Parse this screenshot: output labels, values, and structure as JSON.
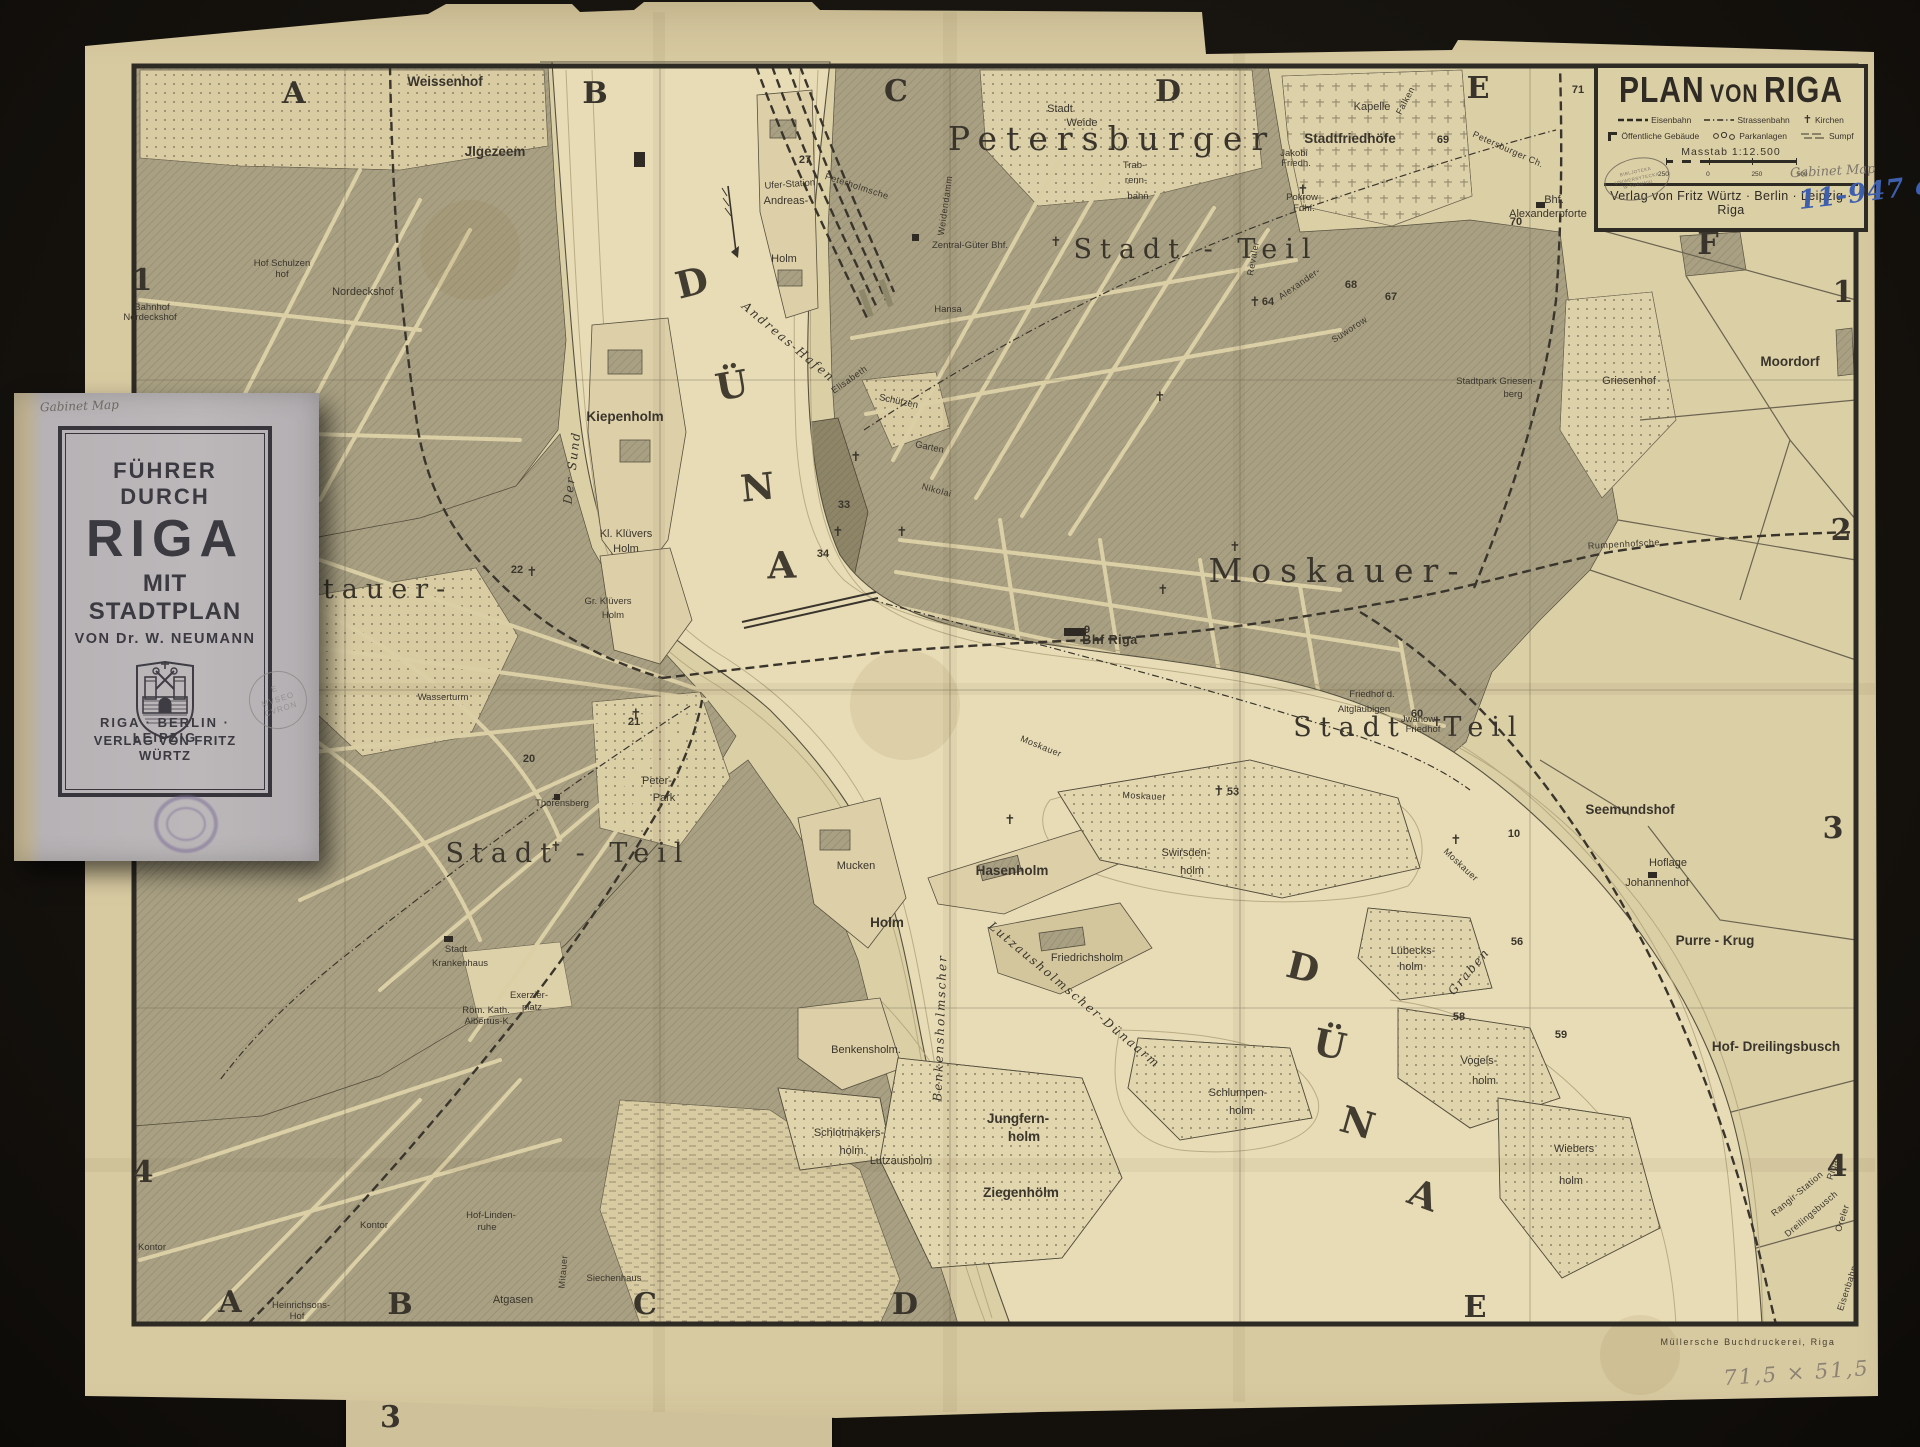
{
  "cartouche": {
    "title_parts": [
      "PLAN",
      "VON",
      "RIGA"
    ],
    "legend": [
      {
        "icon": "railway-dashes",
        "label": "Eisenbahn"
      },
      {
        "icon": "tram-dashdot",
        "label": "Strassenbahn"
      },
      {
        "icon": "church-cross",
        "label": "Kirchen"
      },
      {
        "icon": "public-building-mark",
        "label": "Öffentliche Gebäude"
      },
      {
        "icon": "park-trees",
        "label": "Parkanlagen"
      },
      {
        "icon": "swamp-hatch",
        "label": "Sumpf"
      }
    ],
    "church_glyph": "✝",
    "scale_label": "Masstab 1:12.500",
    "scale_ticks": [
      "250",
      "0",
      "250",
      "500"
    ],
    "library_stamp": [
      "BIBLJOTEKA",
      "UNIWERSYTECKA",
      "W TORUNIU"
    ],
    "pencil_note": "Gabinet Map",
    "ink_note": "11-947 a",
    "publisher": "Verlag von Fritz Würtz · Berlin · Leipzig · Riga"
  },
  "booklet": {
    "pencil_note": "Gabinet Map",
    "title_line1": "FÜHRER DURCH",
    "title_line2": "RIGA",
    "title_line3": "MIT STADTPLAN",
    "author_line": "VON Dr. W. NEUMANN",
    "stamp_lines": [
      "E",
      "MVSEO",
      "CVRON"
    ],
    "cities_line": "RIGA · BERLIN · LEIPZIG",
    "publisher_line": "VERLAG VON FRITZ WÜRTZ"
  },
  "fragment": {
    "digit": "3"
  },
  "colors": {
    "paper": "#d7c9a0",
    "map_base": "#dbcfa6",
    "water": "#e7dcb6",
    "block_hatch": "#a9a083",
    "ink": "#3a352c",
    "ink_note_blue": "#3d5fae",
    "booklet_cover": "#b6b2b5",
    "purple_stamp": "#7b6b94"
  },
  "map": {
    "labels": [
      {
        "t": "A",
        "x": 294,
        "y": 103,
        "c": "grid"
      },
      {
        "t": "B",
        "x": 595,
        "y": 103,
        "c": "grid"
      },
      {
        "t": "C",
        "x": 896,
        "y": 101,
        "c": "grid"
      },
      {
        "t": "D",
        "x": 1168,
        "y": 101,
        "c": "grid"
      },
      {
        "t": "E",
        "x": 1478,
        "y": 98,
        "c": "grid"
      },
      {
        "t": "F",
        "x": 1708,
        "y": 254,
        "c": "grid"
      },
      {
        "t": "A",
        "x": 230,
        "y": 1312,
        "c": "grid"
      },
      {
        "t": "B",
        "x": 400,
        "y": 1314,
        "c": "grid"
      },
      {
        "t": "C",
        "x": 645,
        "y": 1314,
        "c": "grid"
      },
      {
        "t": "D",
        "x": 905,
        "y": 1314,
        "c": "grid"
      },
      {
        "t": "E",
        "x": 1475,
        "y": 1317,
        "c": "grid"
      },
      {
        "t": "1",
        "x": 142,
        "y": 290,
        "c": "grid"
      },
      {
        "t": "4",
        "x": 143,
        "y": 1182,
        "c": "grid"
      },
      {
        "t": "1",
        "x": 1843,
        "y": 302,
        "c": "grid"
      },
      {
        "t": "2",
        "x": 1841,
        "y": 540,
        "c": "grid"
      },
      {
        "t": "3",
        "x": 1833,
        "y": 838,
        "c": "grid"
      },
      {
        "t": "4",
        "x": 1837,
        "y": 1176,
        "c": "grid"
      },
      {
        "t": "Petersburger",
        "x": 1112,
        "y": 150,
        "c": "d1"
      },
      {
        "t": "Stadt - Teil",
        "x": 1196,
        "y": 258,
        "c": "d2"
      },
      {
        "t": "Moskauer-",
        "x": 1338,
        "y": 582,
        "c": "d1"
      },
      {
        "t": "Stadt",
        "x": 1350,
        "y": 736,
        "c": "d2"
      },
      {
        "t": "Teil",
        "x": 1484,
        "y": 736,
        "c": "d2"
      },
      {
        "t": "Mitauer-",
        "x": 362,
        "y": 598,
        "c": "d2"
      },
      {
        "t": "Stadt - Teil",
        "x": 568,
        "y": 862,
        "c": "d2"
      },
      {
        "t": "D",
        "x": 695,
        "y": 295,
        "c": "wl",
        "r": -14
      },
      {
        "t": "Ü",
        "x": 734,
        "y": 398,
        "c": "wl",
        "r": -10
      },
      {
        "t": "N",
        "x": 759,
        "y": 500,
        "c": "wl",
        "r": -6
      },
      {
        "t": "A",
        "x": 782,
        "y": 578,
        "c": "wl",
        "r": -2
      },
      {
        "t": "D",
        "x": 1300,
        "y": 980,
        "c": "wl",
        "r": 14
      },
      {
        "t": "Ü",
        "x": 1327,
        "y": 1057,
        "c": "wl",
        "r": 12
      },
      {
        "t": "N",
        "x": 1354,
        "y": 1135,
        "c": "wl",
        "r": 16
      },
      {
        "t": "A",
        "x": 1419,
        "y": 1207,
        "c": "wl",
        "r": 20
      },
      {
        "t": "Der Sund",
        "x": 576,
        "y": 468,
        "c": "wr",
        "r": -83
      },
      {
        "t": "Andreas-Hafen",
        "x": 786,
        "y": 345,
        "c": "wr",
        "r": 40
      },
      {
        "t": "Lutzausholmscher-Dünaarm",
        "x": 1072,
        "y": 998,
        "c": "wr",
        "r": 40
      },
      {
        "t": "Benkensholmscher",
        "x": 944,
        "y": 1028,
        "c": "wr",
        "r": -88
      },
      {
        "t": "Graben",
        "x": 1472,
        "y": 974,
        "c": "wr",
        "r": -50
      },
      {
        "t": "Weissenhof",
        "x": 445,
        "y": 86,
        "c": "pl"
      },
      {
        "t": "Jlgezeem",
        "x": 495,
        "y": 156,
        "c": "pl"
      },
      {
        "t": "Hof Schulzen",
        "x": 282,
        "y": 266,
        "c": "s9"
      },
      {
        "t": "hof",
        "x": 282,
        "y": 277,
        "c": "s9"
      },
      {
        "t": "Nordeckshof",
        "x": 363,
        "y": 295,
        "c": "sm"
      },
      {
        "t": "Bahnhof",
        "x": 152,
        "y": 310,
        "c": "s9"
      },
      {
        "t": "Nordeckshof",
        "x": 150,
        "y": 320,
        "c": "s9"
      },
      {
        "t": "Stadt",
        "x": 1060,
        "y": 112,
        "c": "sm"
      },
      {
        "t": "Weide",
        "x": 1082,
        "y": 126,
        "c": "sm"
      },
      {
        "t": "Kapelle",
        "x": 1372,
        "y": 110,
        "c": "sm"
      },
      {
        "t": "Stadtfriedhöfe",
        "x": 1350,
        "y": 143,
        "c": "pl"
      },
      {
        "t": "Jakobi",
        "x": 1294,
        "y": 156,
        "c": "s9"
      },
      {
        "t": "Friedh.",
        "x": 1296,
        "y": 166,
        "c": "s9"
      },
      {
        "t": "Pokrow",
        "x": 1302,
        "y": 200,
        "c": "s9"
      },
      {
        "t": "Fdhf.",
        "x": 1304,
        "y": 211,
        "c": "s9"
      },
      {
        "t": "Trab-",
        "x": 1134,
        "y": 168,
        "c": "s9"
      },
      {
        "t": "renn-",
        "x": 1136,
        "y": 183,
        "c": "s9"
      },
      {
        "t": "bahn",
        "x": 1138,
        "y": 199,
        "c": "s9"
      },
      {
        "t": "Zentral-Güter Bhf.",
        "x": 970,
        "y": 248,
        "c": "s9"
      },
      {
        "t": "Bhf.",
        "x": 1554,
        "y": 203,
        "c": "sm"
      },
      {
        "t": "Alexanderpforte",
        "x": 1548,
        "y": 217,
        "c": "sm"
      },
      {
        "t": "Stadtpark Griesen-",
        "x": 1496,
        "y": 384,
        "c": "s9"
      },
      {
        "t": "berg",
        "x": 1513,
        "y": 397,
        "c": "s9"
      },
      {
        "t": "Griesenhof",
        "x": 1629,
        "y": 384,
        "c": "sm"
      },
      {
        "t": "Moordorf",
        "x": 1790,
        "y": 366,
        "c": "pl"
      },
      {
        "t": "Hansa",
        "x": 948,
        "y": 312,
        "c": "s9"
      },
      {
        "t": "Schützen",
        "x": 898,
        "y": 404,
        "c": "s9",
        "r": 12
      },
      {
        "t": "Garten",
        "x": 929,
        "y": 450,
        "c": "s9",
        "r": 12
      },
      {
        "t": "Ufer-Station",
        "x": 790,
        "y": 187,
        "c": "s9",
        "r": -4
      },
      {
        "t": "Andreas-",
        "x": 786,
        "y": 204,
        "c": "sm"
      },
      {
        "t": "Holm",
        "x": 784,
        "y": 262,
        "c": "sm"
      },
      {
        "t": "Kiepenholm",
        "x": 625,
        "y": 421,
        "c": "pl"
      },
      {
        "t": "Kl. Klüvers",
        "x": 626,
        "y": 537,
        "c": "sm"
      },
      {
        "t": "Holm",
        "x": 626,
        "y": 552,
        "c": "sm"
      },
      {
        "t": "Gr. Klüvers",
        "x": 608,
        "y": 604,
        "c": "s9"
      },
      {
        "t": "Holm",
        "x": 613,
        "y": 618,
        "c": "s9"
      },
      {
        "t": "Wasserturm",
        "x": 443,
        "y": 700,
        "c": "s9"
      },
      {
        "t": "Peter-",
        "x": 657,
        "y": 784,
        "c": "sm"
      },
      {
        "t": "Park",
        "x": 664,
        "y": 801,
        "c": "sm"
      },
      {
        "t": "Thorensberg",
        "x": 562,
        "y": 806,
        "c": "s9"
      },
      {
        "t": "Stadt",
        "x": 456,
        "y": 952,
        "c": "s9"
      },
      {
        "t": "Krankenhaus",
        "x": 460,
        "y": 966,
        "c": "s9"
      },
      {
        "t": "Exerzier-",
        "x": 529,
        "y": 998,
        "c": "s9"
      },
      {
        "t": "platz",
        "x": 532,
        "y": 1010,
        "c": "s9"
      },
      {
        "t": "Röm. Kath.",
        "x": 486,
        "y": 1013,
        "c": "s9"
      },
      {
        "t": "Albertus-K.",
        "x": 488,
        "y": 1024,
        "c": "s9"
      },
      {
        "t": "Hof-Linden-",
        "x": 491,
        "y": 1218,
        "c": "s9"
      },
      {
        "t": "ruhe",
        "x": 487,
        "y": 1230,
        "c": "s9"
      },
      {
        "t": "Atgasen",
        "x": 513,
        "y": 1303,
        "c": "sm"
      },
      {
        "t": "Siechenhaus",
        "x": 614,
        "y": 1281,
        "c": "s9"
      },
      {
        "t": "Heinrichsons-",
        "x": 301,
        "y": 1308,
        "c": "s9"
      },
      {
        "t": "Hof",
        "x": 297,
        "y": 1319,
        "c": "s9"
      },
      {
        "t": "Kontor",
        "x": 152,
        "y": 1250,
        "c": "s9"
      },
      {
        "t": "Kontor",
        "x": 374,
        "y": 1228,
        "c": "s9"
      },
      {
        "t": "Bhf Riga",
        "x": 1110,
        "y": 644,
        "c": "plb"
      },
      {
        "t": "Friedhof d.",
        "x": 1372,
        "y": 697,
        "c": "s9"
      },
      {
        "t": "Altgläubigen",
        "x": 1364,
        "y": 712,
        "c": "s9"
      },
      {
        "t": "Jwanow",
        "x": 1418,
        "y": 722,
        "c": "s9"
      },
      {
        "t": "Friedhof",
        "x": 1423,
        "y": 732,
        "c": "s9"
      },
      {
        "t": "Seemundshof",
        "x": 1630,
        "y": 814,
        "c": "pl"
      },
      {
        "t": "Hoflage",
        "x": 1668,
        "y": 866,
        "c": "sm"
      },
      {
        "t": "Johannenhof",
        "x": 1657,
        "y": 886,
        "c": "sm"
      },
      {
        "t": "Purre - Krug",
        "x": 1715,
        "y": 945,
        "c": "pl"
      },
      {
        "t": "Hof- Dreilingsbusch",
        "x": 1776,
        "y": 1051,
        "c": "pl"
      },
      {
        "t": "Lübecks-",
        "x": 1413,
        "y": 954,
        "c": "sm"
      },
      {
        "t": "holm",
        "x": 1411,
        "y": 970,
        "c": "sm"
      },
      {
        "t": "Vogels-",
        "x": 1479,
        "y": 1064,
        "c": "sm"
      },
      {
        "t": "holm",
        "x": 1484,
        "y": 1084,
        "c": "sm"
      },
      {
        "t": "Wiebers",
        "x": 1574,
        "y": 1152,
        "c": "sm"
      },
      {
        "t": "holm",
        "x": 1571,
        "y": 1184,
        "c": "sm"
      },
      {
        "t": "Schlumpen-",
        "x": 1238,
        "y": 1096,
        "c": "sm"
      },
      {
        "t": "holm",
        "x": 1241,
        "y": 1114,
        "c": "sm"
      },
      {
        "t": "Swirsden-",
        "x": 1186,
        "y": 856,
        "c": "sm"
      },
      {
        "t": "holm",
        "x": 1192,
        "y": 874,
        "c": "sm"
      },
      {
        "t": "Hasenholm",
        "x": 1012,
        "y": 875,
        "c": "pl"
      },
      {
        "t": "Friedrichsholm",
        "x": 1087,
        "y": 961,
        "c": "sm"
      },
      {
        "t": "Mucken",
        "x": 856,
        "y": 869,
        "c": "sm"
      },
      {
        "t": "Holm",
        "x": 887,
        "y": 927,
        "c": "pl"
      },
      {
        "t": "Benkensholm.",
        "x": 866,
        "y": 1053,
        "c": "sm"
      },
      {
        "t": "Jungfern-",
        "x": 1018,
        "y": 1123,
        "c": "pl"
      },
      {
        "t": "holm",
        "x": 1024,
        "y": 1141,
        "c": "pl"
      },
      {
        "t": "Lutzausholm",
        "x": 901,
        "y": 1164,
        "c": "sm"
      },
      {
        "t": "Ziegenhölm",
        "x": 1021,
        "y": 1197,
        "c": "pl"
      },
      {
        "t": "Schlotmakers-",
        "x": 849,
        "y": 1136,
        "c": "sm"
      },
      {
        "t": "holm.",
        "x": 853,
        "y": 1154,
        "c": "sm"
      },
      {
        "t": "Moskauer",
        "x": 1040,
        "y": 749,
        "c": "st",
        "r": 22
      },
      {
        "t": "Moskauer",
        "x": 1144,
        "y": 799,
        "c": "st",
        "r": 3
      },
      {
        "t": "Moskauer",
        "x": 1459,
        "y": 867,
        "c": "st",
        "r": 43
      },
      {
        "t": "Nikolai",
        "x": 936,
        "y": 493,
        "c": "st",
        "r": 15
      },
      {
        "t": "Elisabeth",
        "x": 851,
        "y": 382,
        "c": "st",
        "r": -35
      },
      {
        "t": "Weidendamm",
        "x": 948,
        "y": 206,
        "c": "st",
        "r": -82
      },
      {
        "t": "Petersburger Ch.",
        "x": 1507,
        "y": 152,
        "c": "st",
        "r": 24
      },
      {
        "t": "Falken",
        "x": 1408,
        "y": 102,
        "c": "st",
        "r": -62
      },
      {
        "t": "Mitauer",
        "x": 566,
        "y": 1272,
        "c": "st",
        "r": -85
      },
      {
        "t": "Riga-",
        "x": 1836,
        "y": 1169,
        "c": "st",
        "r": -72
      },
      {
        "t": "Oreler",
        "x": 1845,
        "y": 1219,
        "c": "st",
        "r": -72
      },
      {
        "t": "Eisenbahn",
        "x": 1850,
        "y": 1289,
        "c": "st",
        "r": -72
      },
      {
        "t": "Rangir-Station",
        "x": 1799,
        "y": 1196,
        "c": "st",
        "r": -40
      },
      {
        "t": "Dreilingsbusch",
        "x": 1813,
        "y": 1216,
        "c": "st",
        "r": -40
      },
      {
        "t": "Alexander-",
        "x": 1301,
        "y": 286,
        "c": "st",
        "r": -35
      },
      {
        "t": "Suworow",
        "x": 1351,
        "y": 332,
        "c": "st",
        "r": -33
      },
      {
        "t": "Revaler",
        "x": 1256,
        "y": 259,
        "c": "st",
        "r": -80
      },
      {
        "t": "Peterholmsche",
        "x": 856,
        "y": 189,
        "c": "st",
        "r": 18
      },
      {
        "t": "Rumpenhofsche",
        "x": 1624,
        "y": 547,
        "c": "st",
        "r": -3
      },
      {
        "t": "27",
        "x": 805,
        "y": 163,
        "c": "num"
      },
      {
        "t": "69",
        "x": 1443,
        "y": 143,
        "c": "num"
      },
      {
        "t": "71",
        "x": 1578,
        "y": 93,
        "c": "num"
      },
      {
        "t": "68",
        "x": 1351,
        "y": 288,
        "c": "num"
      },
      {
        "t": "67",
        "x": 1391,
        "y": 300,
        "c": "num"
      },
      {
        "t": "64",
        "x": 1268,
        "y": 305,
        "c": "num"
      },
      {
        "t": "70",
        "x": 1516,
        "y": 225,
        "c": "num"
      },
      {
        "t": "9",
        "x": 1087,
        "y": 633,
        "c": "num"
      },
      {
        "t": "53",
        "x": 1233,
        "y": 795,
        "c": "num"
      },
      {
        "t": "60",
        "x": 1417,
        "y": 717,
        "c": "num"
      },
      {
        "t": "58",
        "x": 1459,
        "y": 1020,
        "c": "num"
      },
      {
        "t": "56",
        "x": 1517,
        "y": 945,
        "c": "num"
      },
      {
        "t": "59",
        "x": 1561,
        "y": 1038,
        "c": "num"
      },
      {
        "t": "10",
        "x": 1514,
        "y": 837,
        "c": "num"
      },
      {
        "t": "21",
        "x": 634,
        "y": 725,
        "c": "num"
      },
      {
        "t": "22",
        "x": 517,
        "y": 573,
        "c": "num"
      },
      {
        "t": "20",
        "x": 529,
        "y": 762,
        "c": "num"
      },
      {
        "t": "33",
        "x": 844,
        "y": 508,
        "c": "num"
      },
      {
        "t": "34",
        "x": 823,
        "y": 557,
        "c": "num"
      },
      {
        "t": "✝",
        "x": 856,
        "y": 461,
        "c": "cross"
      },
      {
        "t": "✝",
        "x": 838,
        "y": 536,
        "c": "cross"
      },
      {
        "t": "✝",
        "x": 902,
        "y": 536,
        "c": "cross"
      },
      {
        "t": "✝",
        "x": 1160,
        "y": 401,
        "c": "cross"
      },
      {
        "t": "✝",
        "x": 1235,
        "y": 551,
        "c": "cross"
      },
      {
        "t": "✝",
        "x": 1010,
        "y": 824,
        "c": "cross"
      },
      {
        "t": "✝",
        "x": 1255,
        "y": 306,
        "c": "cross"
      },
      {
        "t": "✝",
        "x": 1303,
        "y": 194,
        "c": "cross"
      },
      {
        "t": "✝",
        "x": 532,
        "y": 576,
        "c": "cross"
      },
      {
        "t": "✝",
        "x": 636,
        "y": 718,
        "c": "cross"
      },
      {
        "t": "✝",
        "x": 556,
        "y": 851,
        "c": "cross"
      },
      {
        "t": "✝",
        "x": 1456,
        "y": 844,
        "c": "cross"
      },
      {
        "t": "✝",
        "x": 1163,
        "y": 594,
        "c": "cross"
      },
      {
        "t": "✝",
        "x": 1056,
        "y": 246,
        "c": "cross"
      },
      {
        "t": "✝",
        "x": 1437,
        "y": 726,
        "c": "cross"
      },
      {
        "t": "✝",
        "x": 1219,
        "y": 795,
        "c": "cross"
      },
      {
        "t": "Müllersche Buchdruckerei, Riga",
        "x": 1748,
        "y": 1345,
        "c": "credit"
      },
      {
        "t": "71,5 × 51,5",
        "x": 1797,
        "y": 1380,
        "c": "hand",
        "r": -4
      }
    ]
  }
}
